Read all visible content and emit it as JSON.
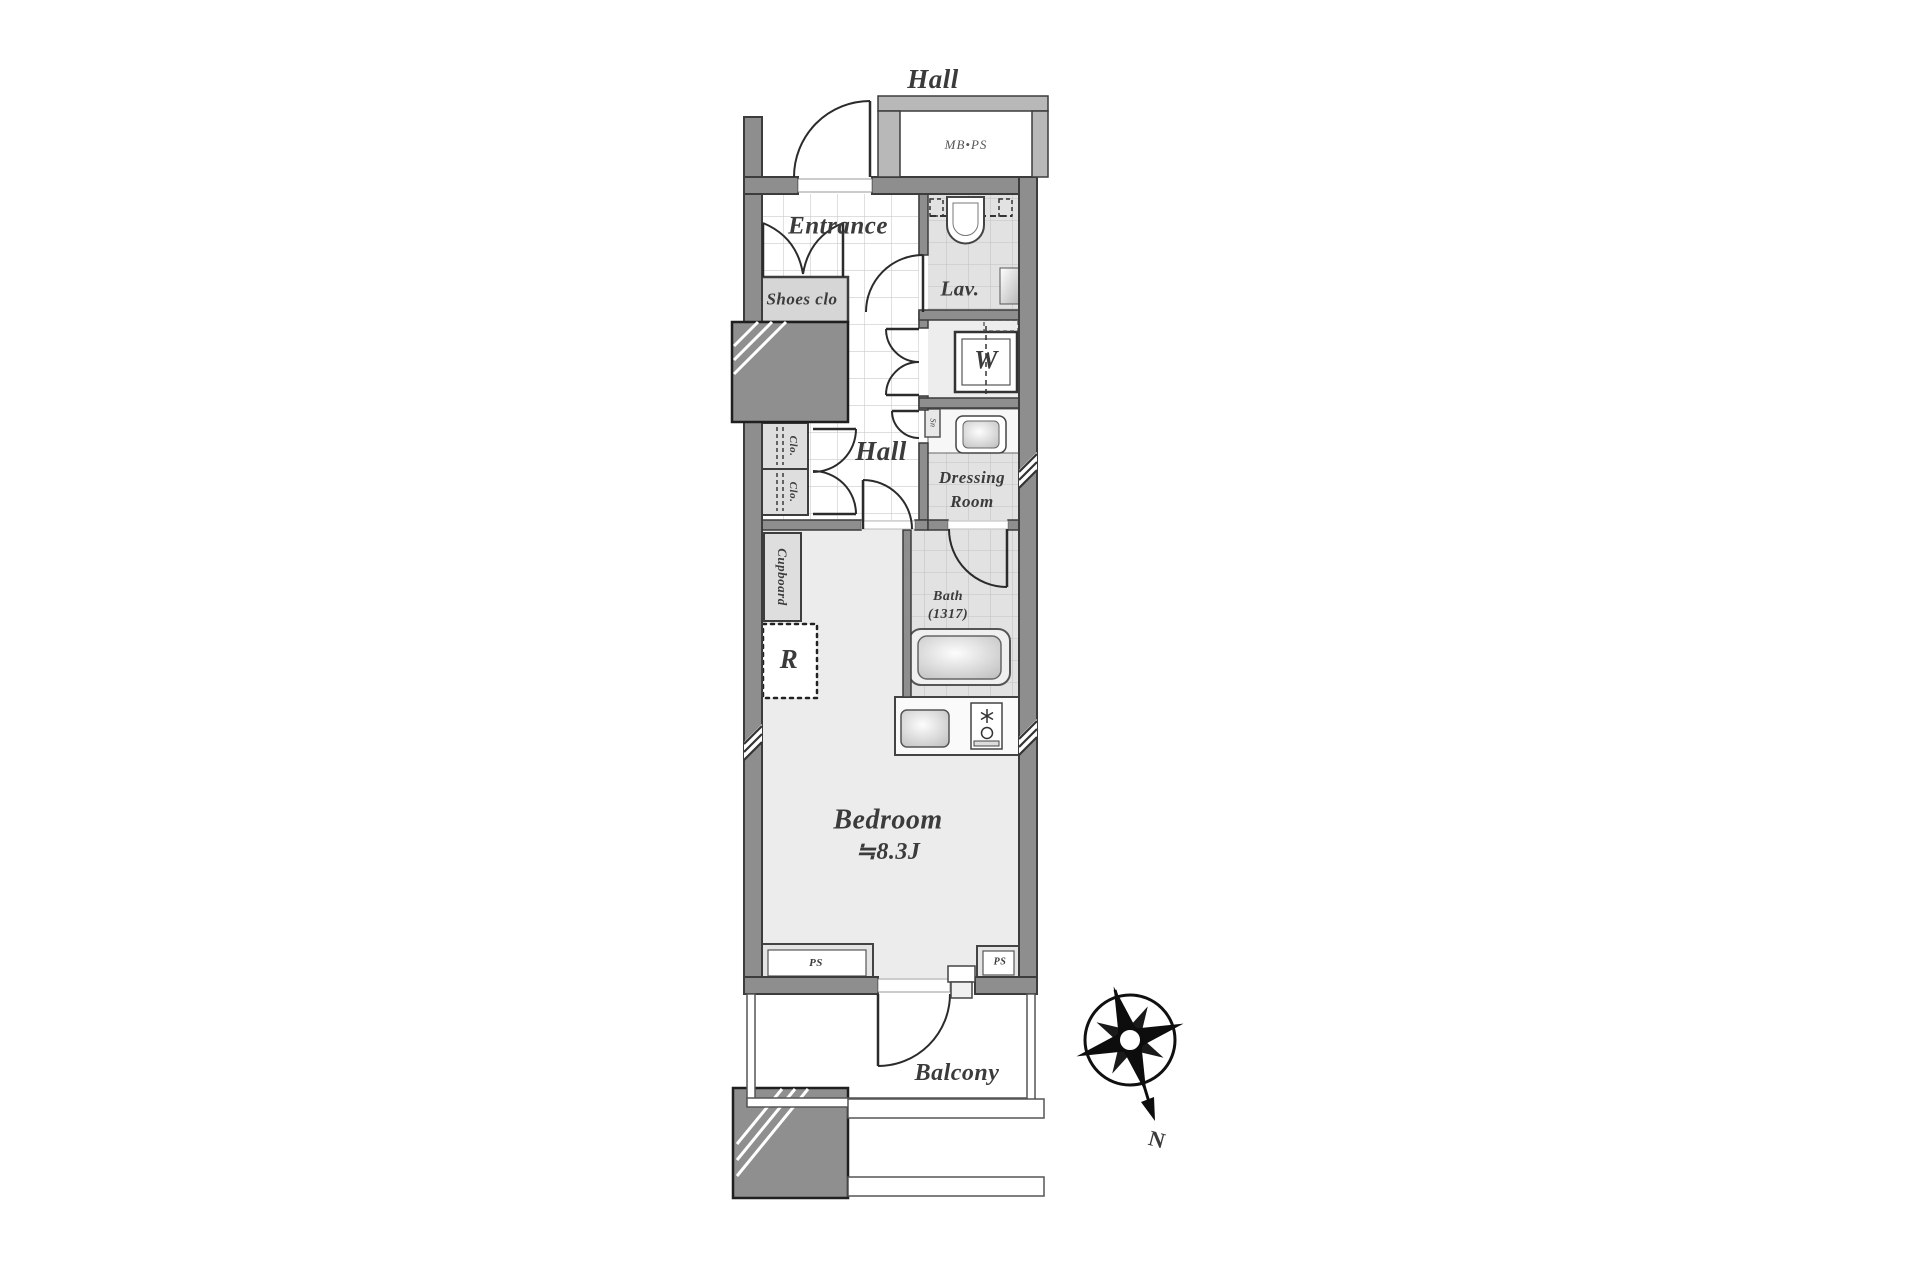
{
  "colors": {
    "wall": "#8e8e8e",
    "wall-stroke": "#3c3c3c",
    "hall-wall": "#b8b8b8",
    "floor": "#ececec",
    "tile-floor": "#e2e2e2",
    "block": "#8f8f8f",
    "ink": "#3b3b3b"
  },
  "labels": {
    "hall_outer": "Hall",
    "mb_ps": "MB•PS",
    "entrance": "Entrance",
    "shoes_closet": "Shoes clo",
    "lavatory": "Lav.",
    "washer": "W",
    "sn": "Sn",
    "hall_inner": "Hall",
    "dressing_line1": "Dressing",
    "dressing_line2": "Room",
    "closet_1": "Clo.",
    "closet_2": "Clo.",
    "cupboard": "Cupboard",
    "refrigerator": "R",
    "bath_line1": "Bath",
    "bath_line2": "(1317)",
    "bedroom": "Bedroom",
    "bedroom_size": "≒8.3J",
    "ps_left": "PS",
    "ps_right": "PS",
    "balcony": "Balcony",
    "north": "N"
  }
}
